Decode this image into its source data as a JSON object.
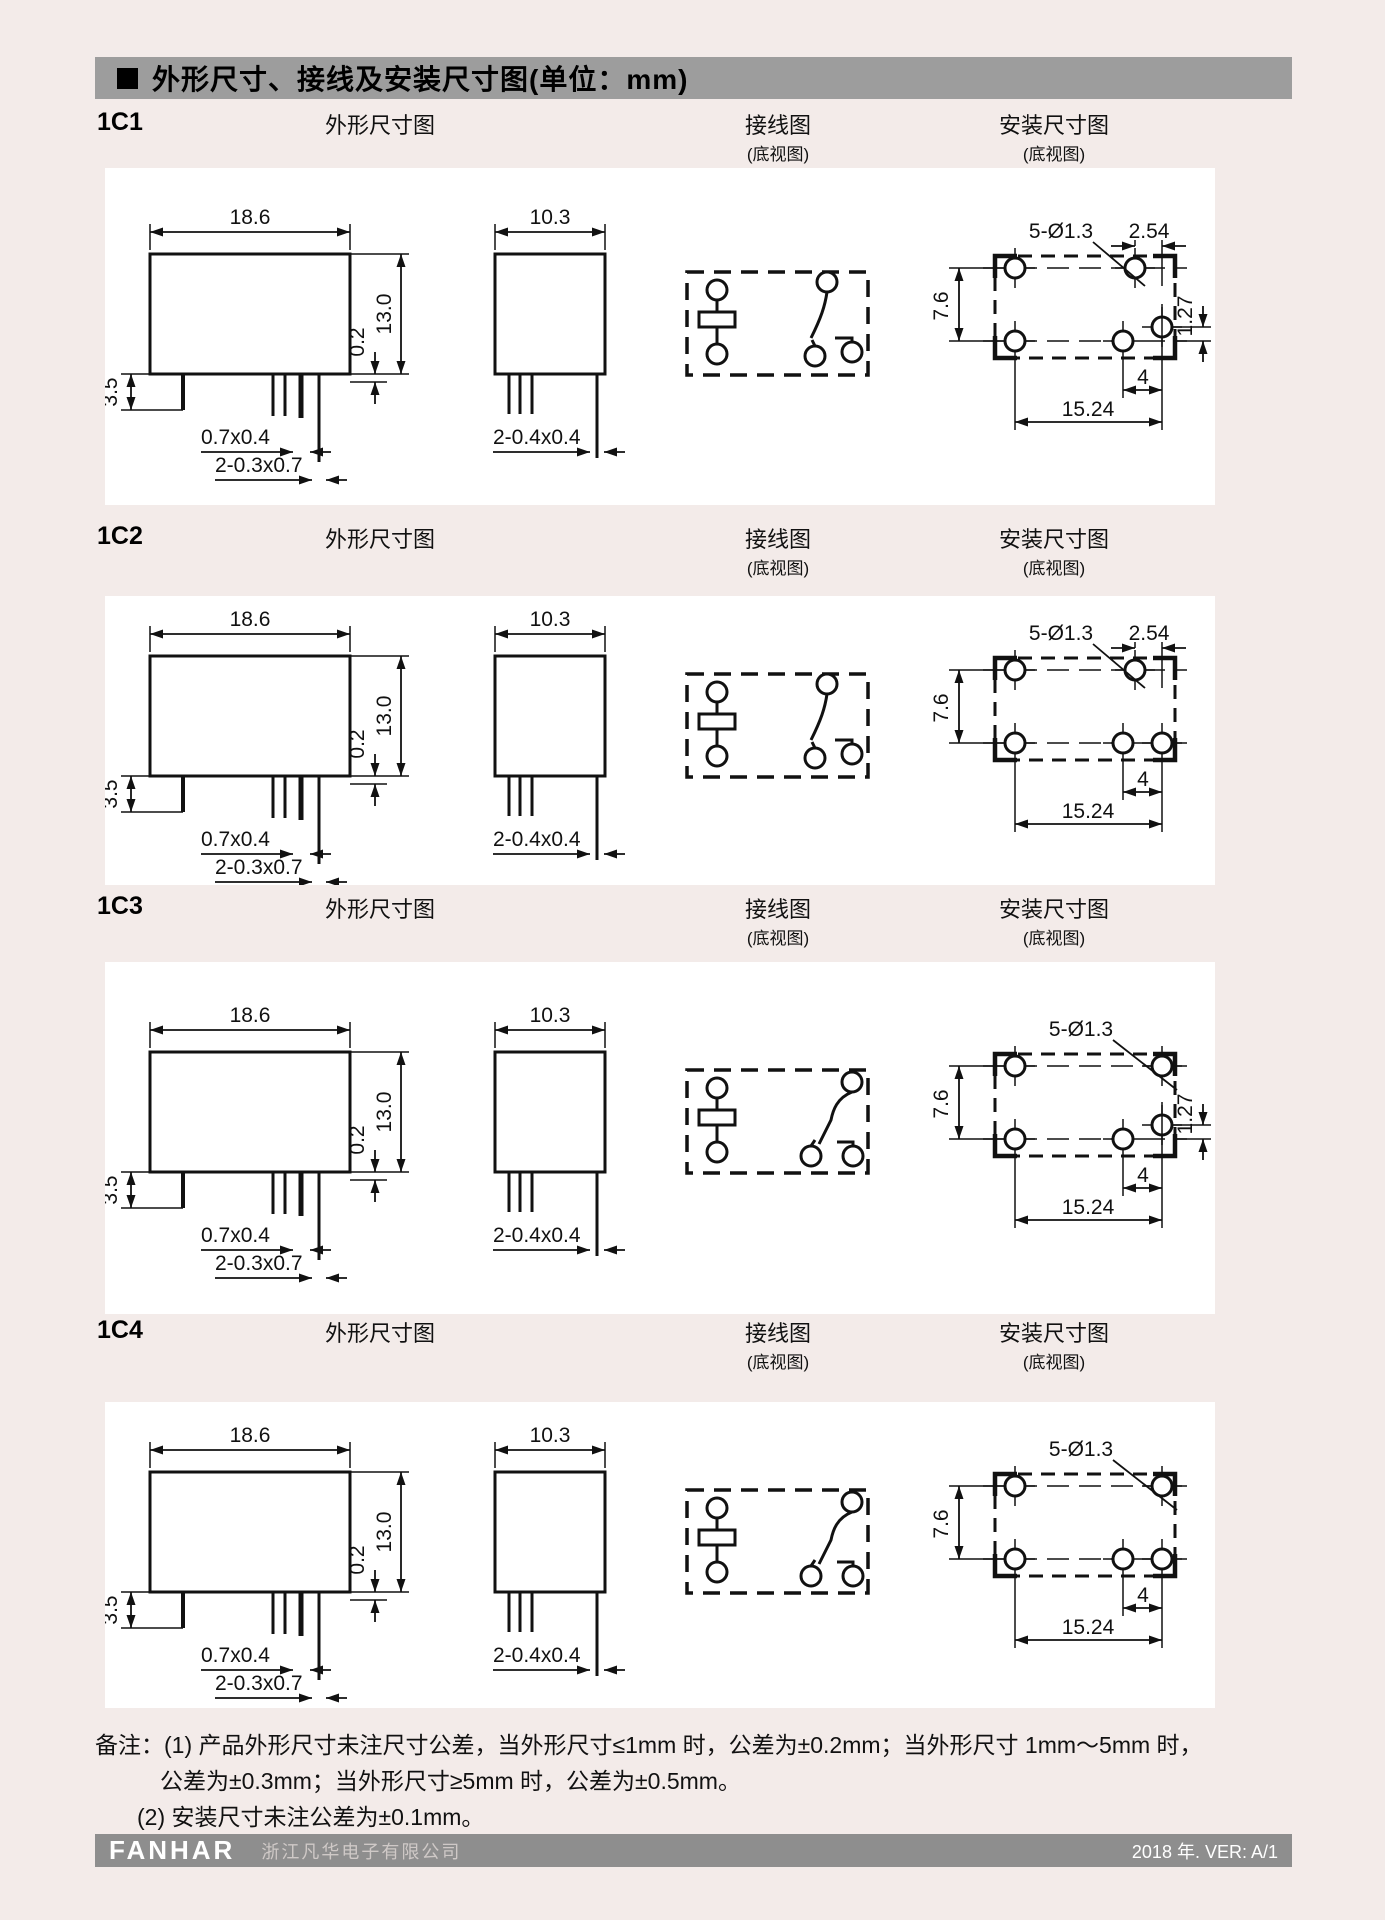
{
  "header": {
    "title": "外形尺寸、接线及安装尺寸图(单位：mm)"
  },
  "columns": {
    "outline": "外形尺寸图",
    "wiring": "接线图",
    "mounting": "安装尺寸图",
    "bottom_view": "(底视图)"
  },
  "sections": [
    {
      "id": "1C1",
      "dims": {
        "front_width": "18.6",
        "side_width": "10.3",
        "height": "13.0",
        "standoff": "0.2",
        "pin_length": "3.5",
        "pin_size_a": "0.7x0.4",
        "pin_size_b": "2-0.3x0.7",
        "pin_size_c": "2-0.4x0.4",
        "holes": "5-Ø1.3",
        "hole_pitch_x": "2.54",
        "hole_offset_y": "1.27",
        "row_spacing": "7.6",
        "pin_span_small": "4",
        "pin_span_large": "15.24"
      }
    },
    {
      "id": "1C2",
      "dims": {
        "front_width": "18.6",
        "side_width": "10.3",
        "height": "13.0",
        "standoff": "0.2",
        "pin_length": "3.5",
        "pin_size_a": "0.7x0.4",
        "pin_size_b": "2-0.3x0.7",
        "pin_size_c": "2-0.4x0.4",
        "holes": "5-Ø1.3",
        "hole_pitch_x": "2.54",
        "row_spacing": "7.6",
        "pin_span_small": "4",
        "pin_span_large": "15.24"
      }
    },
    {
      "id": "1C3",
      "dims": {
        "front_width": "18.6",
        "side_width": "10.3",
        "height": "13.0",
        "standoff": "0.2",
        "pin_length": "3.5",
        "pin_size_a": "0.7x0.4",
        "pin_size_b": "2-0.3x0.7",
        "pin_size_c": "2-0.4x0.4",
        "holes": "5-Ø1.3",
        "hole_offset_y": "1.27",
        "row_spacing": "7.6",
        "pin_span_small": "4",
        "pin_span_large": "15.24"
      }
    },
    {
      "id": "1C4",
      "dims": {
        "front_width": "18.6",
        "side_width": "10.3",
        "height": "13.0",
        "standoff": "0.2",
        "pin_length": "3.5",
        "pin_size_a": "0.7x0.4",
        "pin_size_b": "2-0.3x0.7",
        "pin_size_c": "2-0.4x0.4",
        "holes": "5-Ø1.3",
        "row_spacing": "7.6",
        "pin_span_small": "4",
        "pin_span_large": "15.24"
      }
    }
  ],
  "notes": {
    "line1": "备注：(1) 产品外形尺寸未注尺寸公差，当外形尺寸≤1mm 时，公差为±0.2mm；当外形尺寸 1mm～5mm 时，",
    "line2": "公差为±0.3mm；当外形尺寸≥5mm 时，公差为±0.5mm。",
    "line3": "(2) 安装尺寸未注公差为±0.1mm。"
  },
  "footer": {
    "logo": "FANHAR",
    "company": "浙江凡华电子有限公司",
    "version": "2018 年. VER: A/1"
  },
  "colors": {
    "page_bg": "#f3ebe9",
    "panel_bg": "#ffffff",
    "header_bar": "#9d9d9d",
    "footer_bar": "#8e8e8e",
    "line": "#111111"
  }
}
